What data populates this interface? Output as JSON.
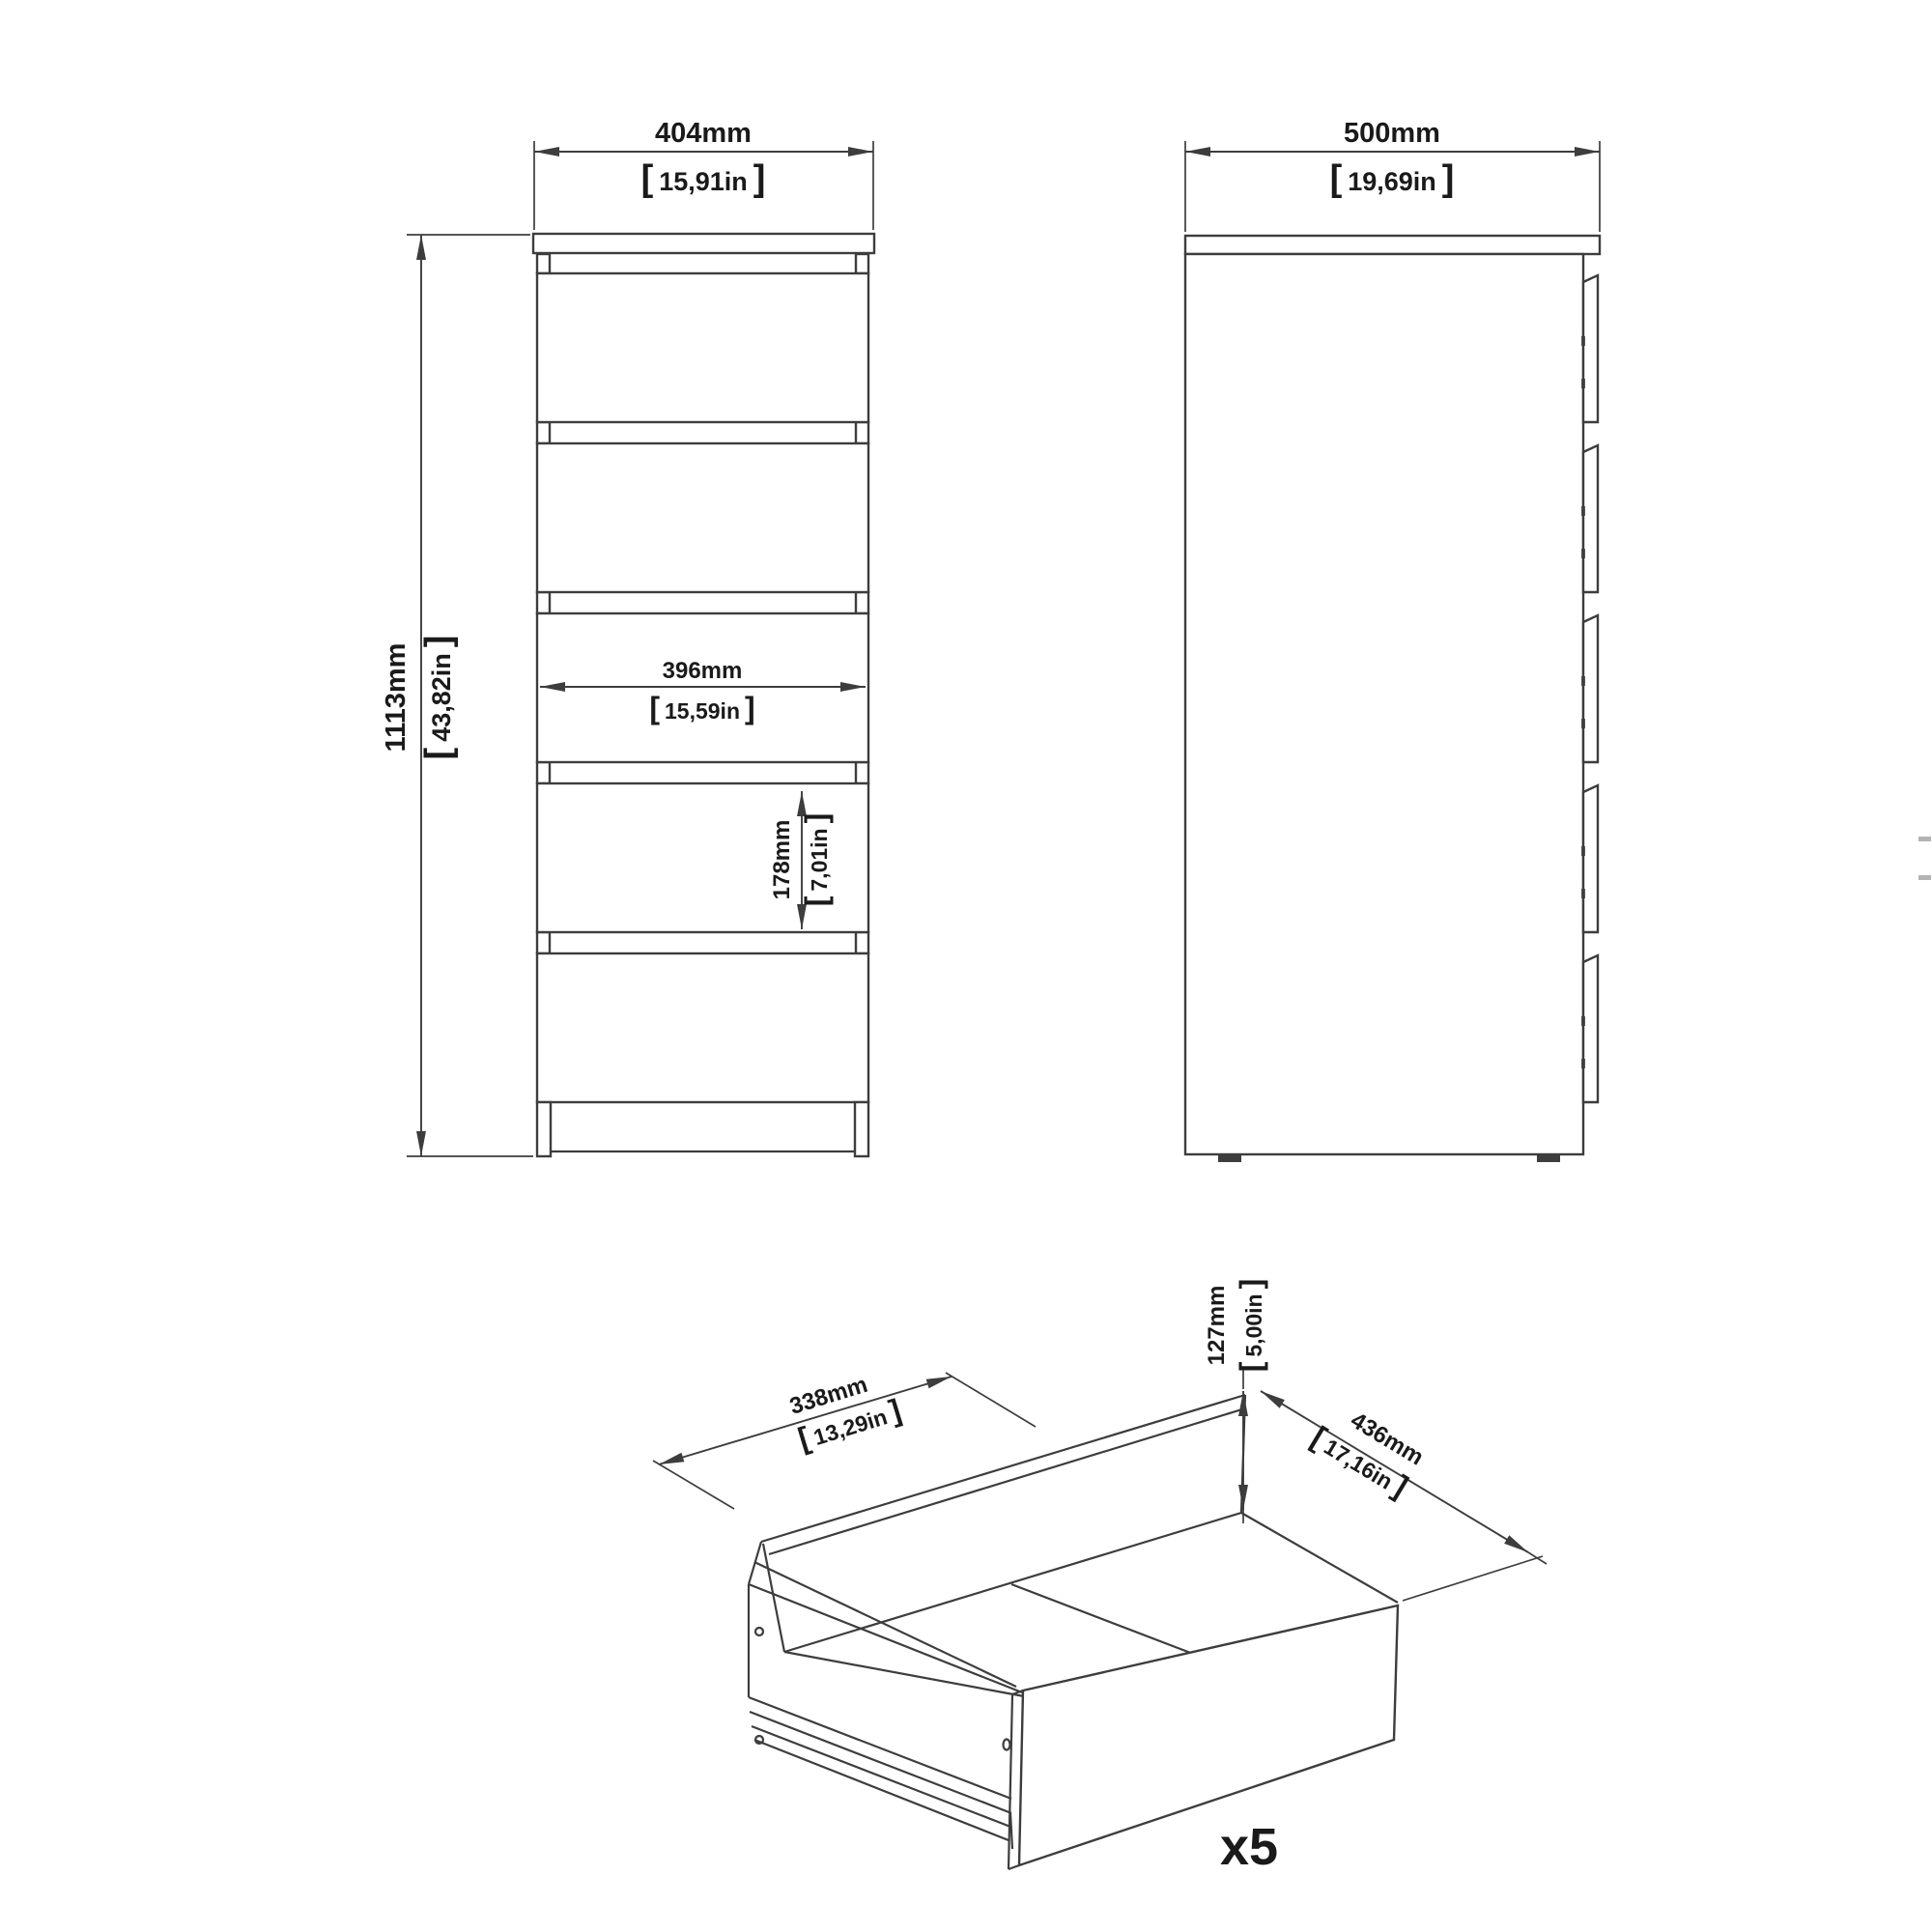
{
  "drawing": {
    "bracket_open": "[",
    "bracket_close": "]",
    "colors": {
      "line": "#3d3d3d",
      "text": "#1a1a1a",
      "background": "#ffffff"
    }
  },
  "front_view": {
    "width": {
      "mm": "404mm",
      "inches": "15,91in"
    },
    "height": {
      "mm": "1113mm",
      "inches": "43,82in"
    },
    "drawer_width": {
      "mm": "396mm",
      "inches": "15,59in"
    },
    "drawer_height": {
      "mm": "178mm",
      "inches": "7,01in"
    },
    "drawer_count": 5
  },
  "side_view": {
    "depth": {
      "mm": "500mm",
      "inches": "19,69in"
    },
    "drawer_front_count": 5
  },
  "drawer_detail": {
    "width": {
      "mm": "338mm",
      "inches": "13,29in"
    },
    "height": {
      "mm": "127mm",
      "inches": "5,00in"
    },
    "depth": {
      "mm": "436mm",
      "inches": "17,16in"
    },
    "quantity": "x5"
  }
}
